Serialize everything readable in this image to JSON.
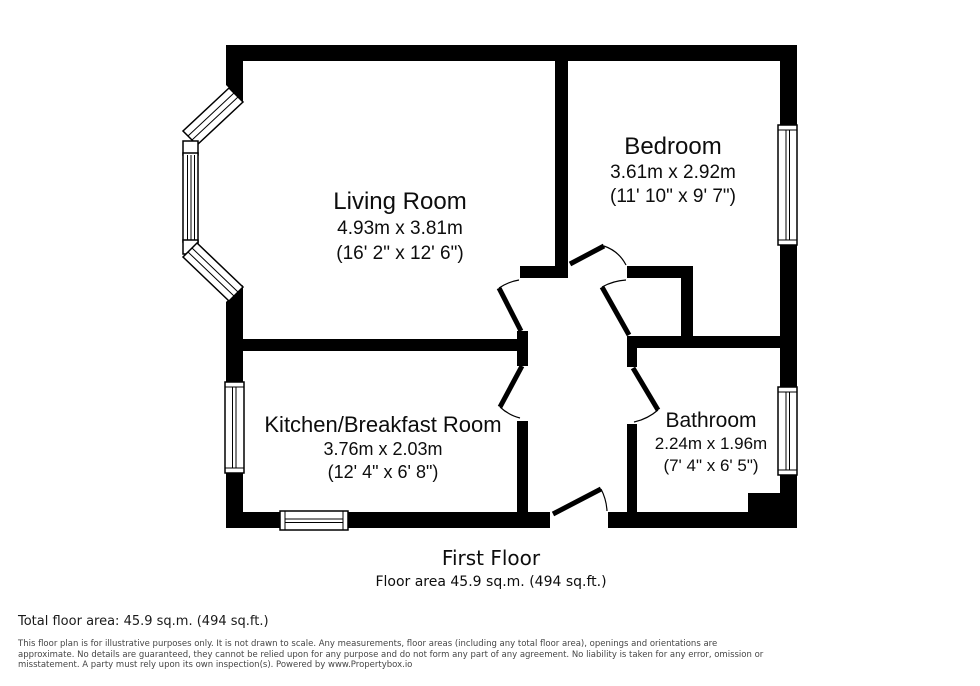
{
  "plan": {
    "floor_label": "First Floor",
    "floor_area_label": "Floor area 45.9 sq.m. (494 sq.ft.)",
    "rooms": [
      {
        "name": "Living Room",
        "metric": "4.93m x 3.81m",
        "imperial": "(16' 2\" x 12' 6\")"
      },
      {
        "name": "Bedroom",
        "metric": "3.61m x 2.92m",
        "imperial": "(11' 10\" x 9' 7\")"
      },
      {
        "name": "Kitchen/Breakfast Room",
        "metric": "3.76m x 2.03m",
        "imperial": "(12' 4\" x 6' 8\")"
      },
      {
        "name": "Bathroom",
        "metric": "2.24m x 1.96m",
        "imperial": "(7' 4\" x 6' 5\")"
      }
    ]
  },
  "footer": {
    "total_area": "Total floor area: 45.9 sq.m. (494 sq.ft.)",
    "disclaimer_lines": [
      "This floor plan is for illustrative purposes only. It is not drawn to scale. Any measurements, floor areas (including any total floor area), openings and orientations are",
      "approximate. No details are guaranteed, they cannot be relied upon for any purpose and do not form any part of any agreement. No liability is taken for any error, omission or",
      "misstatement. A party must rely upon its own inspection(s). Powered by www.Propertybox.io"
    ]
  },
  "colors": {
    "wall": "#000000",
    "background": "#ffffff",
    "room_text": "#0d0d0d",
    "disclaimer_text": "#454545"
  }
}
